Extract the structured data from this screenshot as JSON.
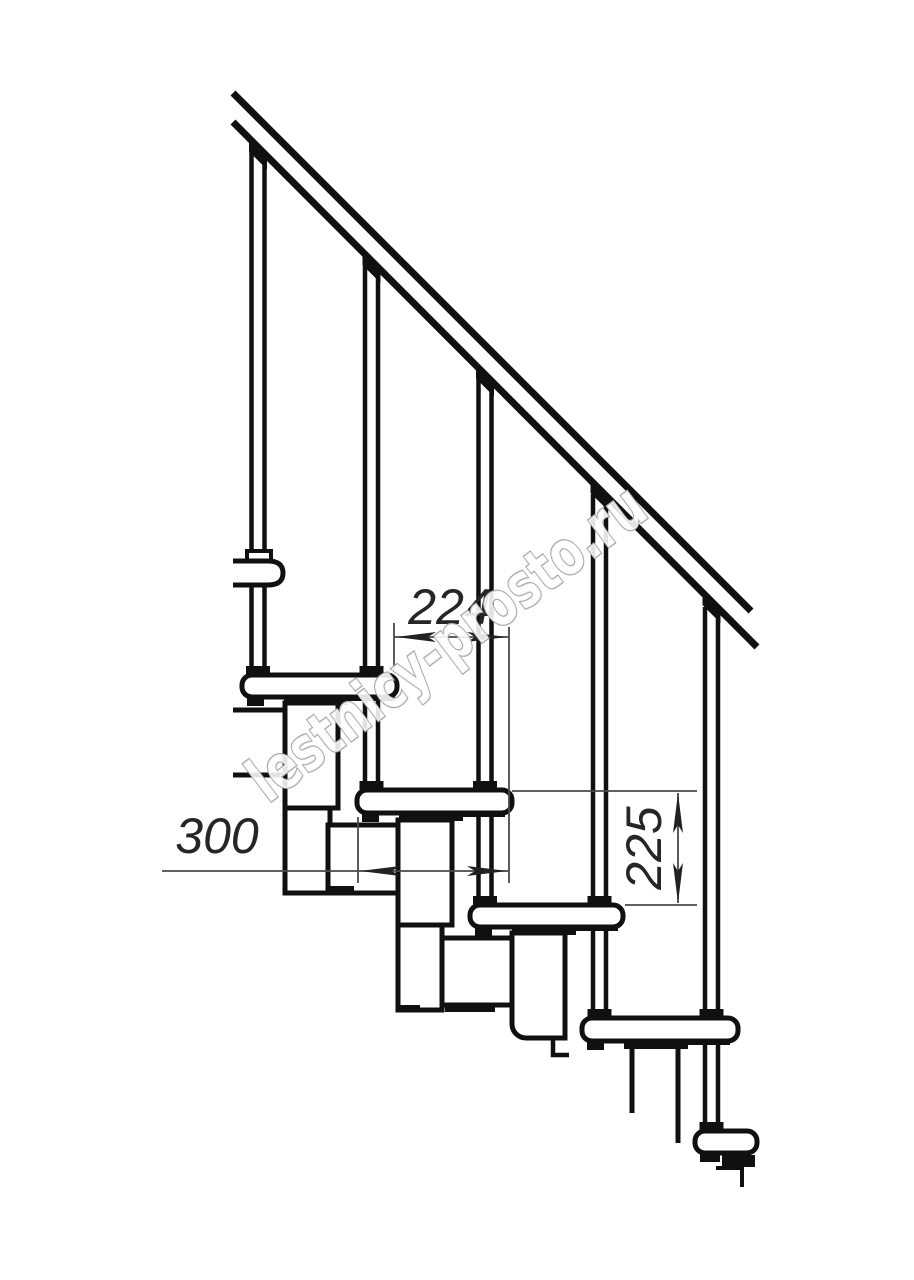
{
  "image": {
    "type": "technical-drawing",
    "subject": "Modular staircase side elevation (fragment)",
    "background_color": "#ffffff",
    "line_color": "#101010"
  },
  "watermark": {
    "text": "lestnicy-prosto.ru",
    "outline_color": "#a6a6a6"
  },
  "dimensions": [
    {
      "id": "step-run",
      "value": "224",
      "orientation": "horizontal"
    },
    {
      "id": "tread-depth",
      "value": "300",
      "orientation": "horizontal"
    },
    {
      "id": "riser-height",
      "value": "225",
      "orientation": "vertical"
    }
  ],
  "components": {
    "handrail": 1,
    "balusters": 5,
    "treads": 5,
    "support_modules": 6
  }
}
